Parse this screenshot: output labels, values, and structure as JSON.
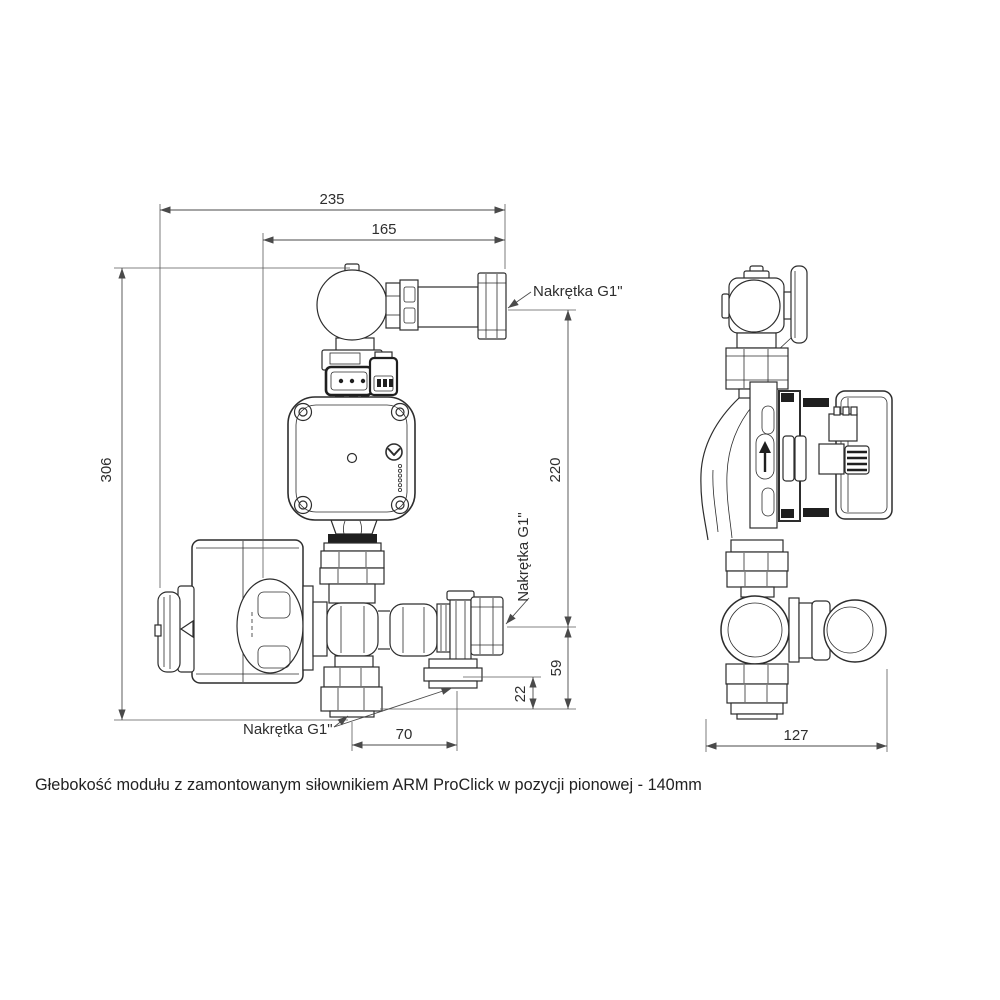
{
  "colors": {
    "line": "#2d2d2d",
    "dimension": "#4a4a4a",
    "background": "#ffffff",
    "gasket_fill": "#1f1f1f"
  },
  "front_view": {
    "dims": {
      "width_total": "235",
      "width_inner": "165",
      "height_total": "306",
      "height_right": "220",
      "height_outlet": "59",
      "offset_bottom": "22",
      "spacing_bottom": "70"
    },
    "labels": {
      "nut_top": "Nakrętka G1\"",
      "nut_middle": "Nakrętka G1\"",
      "nut_bottom": "Nakrętka G1\""
    }
  },
  "side_view": {
    "dims": {
      "depth": "127"
    }
  },
  "caption": "Głebokość modułu z zamontowanym siłownikiem ARM ProClick w pozycji pionowej - 140mm"
}
